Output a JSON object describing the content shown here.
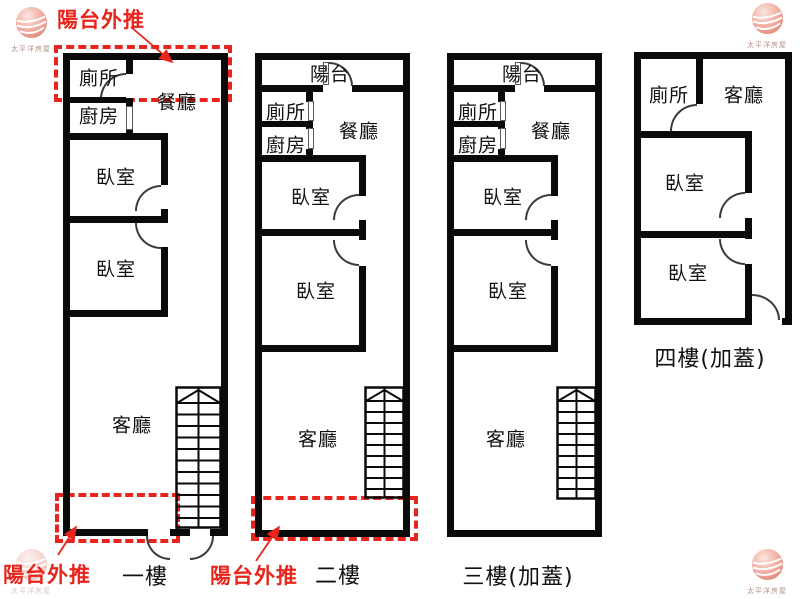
{
  "colors": {
    "red_annotation": "#e8251c",
    "wall": "#0a0a0a"
  },
  "brand": {
    "name": "太平洋房屋"
  },
  "annotations": {
    "balcony_push_top": "陽台外推",
    "balcony_push_bottom_left": "陽台外推",
    "balcony_push_bottom_middle": "陽台外推"
  },
  "floors": [
    {
      "label": "一樓",
      "rooms": {
        "toilet": "廁所",
        "kitchen": "廚房",
        "dining": "餐廳",
        "bedroom1": "臥室",
        "bedroom2": "臥室",
        "living": "客廳"
      }
    },
    {
      "label": "二樓",
      "rooms": {
        "balcony": "陽台",
        "toilet": "廁所",
        "kitchen": "廚房",
        "dining": "餐廳",
        "bedroom1": "臥室",
        "bedroom2": "臥室",
        "living": "客廳"
      }
    },
    {
      "label": "三樓(加蓋)",
      "rooms": {
        "balcony": "陽台",
        "toilet": "廁所",
        "kitchen": "廚房",
        "dining": "餐廳",
        "bedroom1": "臥室",
        "bedroom2": "臥室",
        "living": "客廳"
      }
    },
    {
      "label": "四樓(加蓋)",
      "rooms": {
        "toilet": "廁所",
        "living": "客廳",
        "bedroom1": "臥室",
        "bedroom2": "臥室"
      }
    }
  ]
}
